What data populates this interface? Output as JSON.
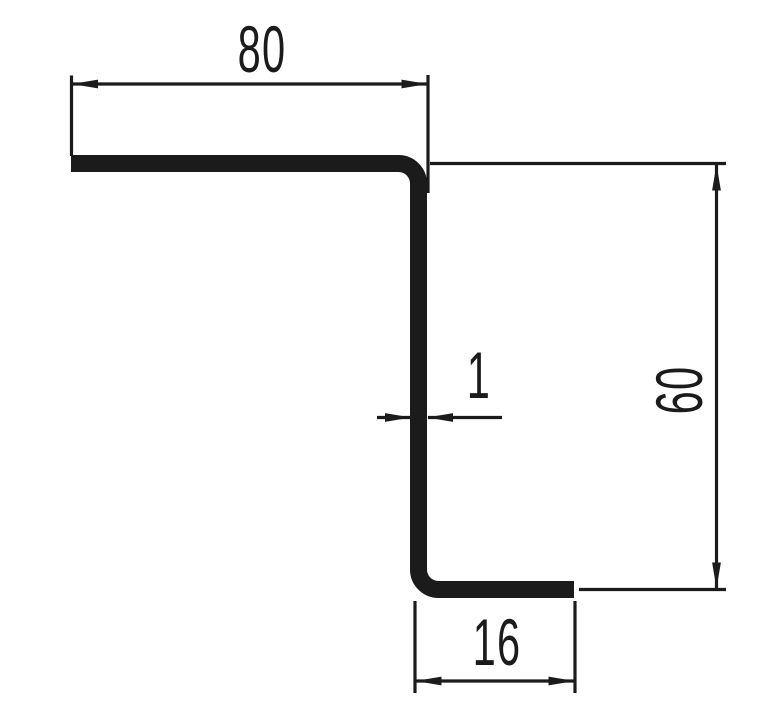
{
  "drawing": {
    "background_color": "#ffffff",
    "line_color": "#1b1b1b",
    "dimensions": {
      "top_flange_width": {
        "value": "80"
      },
      "overall_height": {
        "value": "60"
      },
      "material_thickness": {
        "value": "1"
      },
      "bottom_flange_width": {
        "value": "16"
      }
    }
  }
}
